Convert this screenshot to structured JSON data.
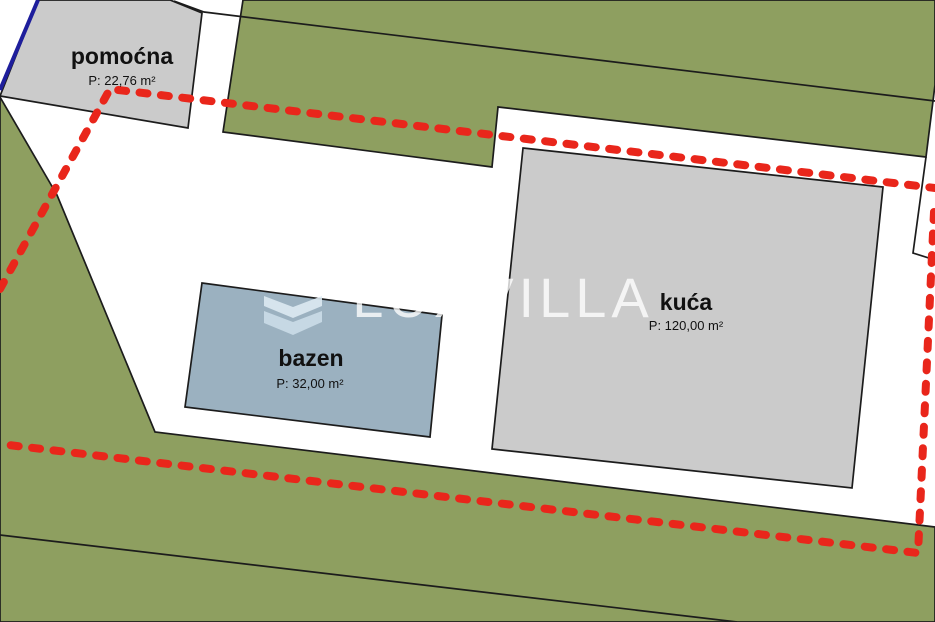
{
  "plan": {
    "watermark": {
      "text": "LUXVILLA"
    },
    "structures": {
      "pomocna": {
        "name": "pomoćna",
        "area": "P: 22,76 m²"
      },
      "kuca": {
        "name": "kuća",
        "area": "P: 120,00 m²"
      },
      "bazen": {
        "name": "bazen",
        "area": "P: 32,00 m²"
      }
    },
    "colors": {
      "parcel_green": "#8E9F60",
      "building_gray": "#CBCBCB",
      "pool_blue": "#9BB1C0",
      "boundary_red": "#E9261B",
      "cadastre_blue": "#1E1E9C",
      "line_black": "#1C1C1C",
      "plot_white": "#FFFFFF"
    }
  }
}
